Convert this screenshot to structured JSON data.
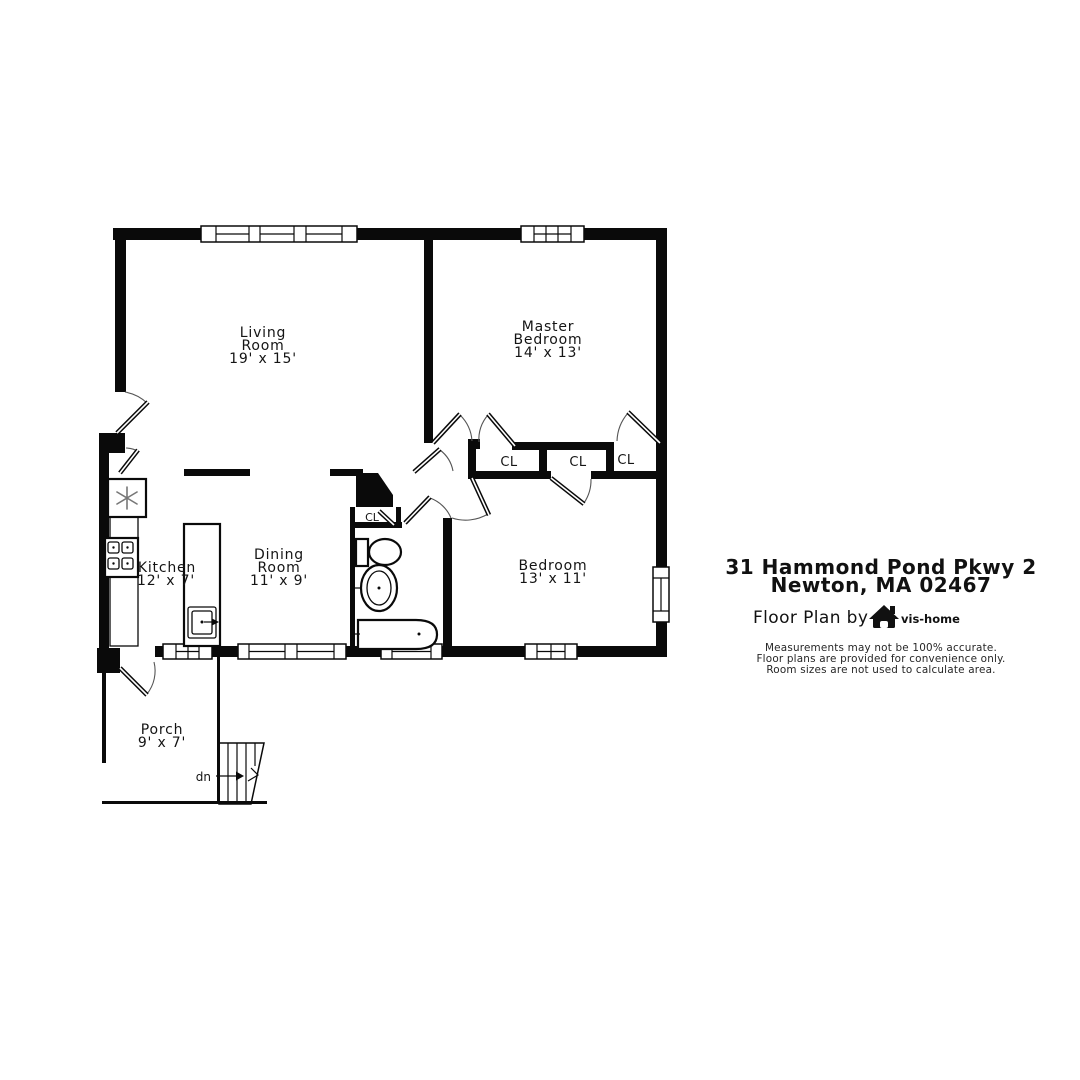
{
  "colors": {
    "background": "#ffffff",
    "wall": "#0a0a0a",
    "door_arc": "#555555",
    "fixture_gray": "#777777"
  },
  "plan": {
    "rooms": {
      "living": {
        "name_line1": "Living",
        "name_line2": "Room",
        "dims": "19' x 15'"
      },
      "master": {
        "name_line1": "Master",
        "name_line2": "Bedroom",
        "dims": "14' x 13'"
      },
      "kitchen": {
        "name_line1": "Kitchen",
        "dims": "12' x 7'"
      },
      "dining": {
        "name_line1": "Dining",
        "name_line2": "Room",
        "dims": "11' x 9'"
      },
      "bedroom": {
        "name_line1": "Bedroom",
        "dims": "13' x 11'"
      },
      "porch": {
        "name_line1": "Porch",
        "dims": "9' x 7'"
      }
    },
    "closets": {
      "cl1": "CL",
      "cl2": "CL",
      "cl3": "CL",
      "bath": "CL"
    },
    "stairs": {
      "down_label": "dn"
    }
  },
  "info": {
    "address_line1": "31 Hammond Pond Pkwy 2",
    "address_line2": "Newton, MA 02467",
    "credit": "Floor Plan by",
    "brand": "vis-home",
    "disclaimer_line1": "Measurements may not be 100% accurate.",
    "disclaimer_line2": "Floor plans are provided for convenience only.",
    "disclaimer_line3": "Room sizes are not used to calculate area."
  }
}
